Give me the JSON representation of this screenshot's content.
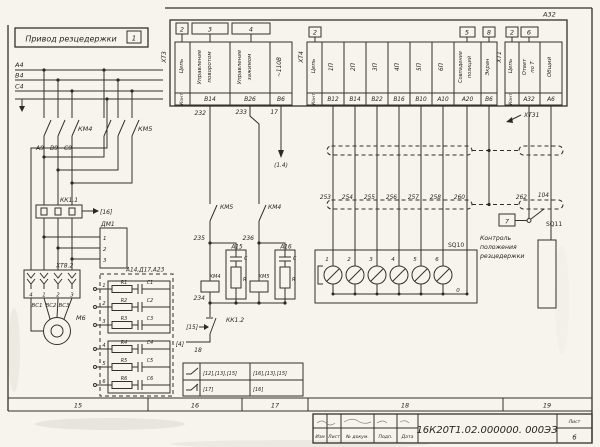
{
  "sheet": {
    "title": "Привод резцедержки",
    "title_zone": "1",
    "doc_number": "16К20Т1.02.000000. 000ЭЗ",
    "sheet_word": "Лист",
    "sheet_number": "6",
    "titleblock_labels": [
      "Изм",
      "Лист",
      "№ докум.",
      "Подп.",
      "Дата"
    ],
    "zones": [
      "15",
      "16",
      "17",
      "18",
      "19"
    ],
    "paper_color": "#f6f4ed",
    "ink_color": "#2e2b24"
  },
  "device": {
    "label": "А32"
  },
  "connectors": {
    "xt3": {
      "name": "ХТ3",
      "circuit_header": "Цепь",
      "contact_header": "Конт",
      "refs": [
        "2",
        "3",
        "4"
      ],
      "cols": [
        {
          "line1": "Управление",
          "line2": "поворотом",
          "pin": "В14",
          "wire": "232"
        },
        {
          "line1": "Управление",
          "line2": "зажимом",
          "pin": "В26",
          "wire": "233"
        },
        {
          "line1": "~110В",
          "line2": "",
          "pin": "В6",
          "wire": "17"
        }
      ]
    },
    "xt4": {
      "name": "ХТ4",
      "circuit_header": "Цепь",
      "contact_header": "Конт",
      "refs": [
        "2",
        "5",
        "8"
      ],
      "cols": [
        {
          "line1": "1П",
          "pin": "В12",
          "wire": "253"
        },
        {
          "line1": "2П",
          "pin": "В14",
          "wire": "254"
        },
        {
          "line1": "3П",
          "pin": "В22",
          "wire": "255"
        },
        {
          "line1": "4П",
          "pin": "В16",
          "wire": "256"
        },
        {
          "line1": "5П",
          "pin": "В10",
          "wire": "257"
        },
        {
          "line1": "6П",
          "pin": "А10",
          "wire": "258"
        },
        {
          "line1": "Совпадение",
          "line2": "позиций",
          "pin": "А20",
          "wire": "260"
        },
        {
          "line1": "Экран",
          "pin": "В6",
          "wire": ""
        }
      ]
    },
    "xt1": {
      "name": "ХТ1",
      "circuit_header": "Цепь",
      "contact_header": "Конт",
      "refs": [
        "2",
        "6"
      ],
      "cols": [
        {
          "line1": "Ответ",
          "line2": "по Т",
          "pin": "А32",
          "wire": "262"
        },
        {
          "line1": "Общий",
          "line2": "",
          "pin": "А6",
          "wire": "104"
        }
      ]
    },
    "xt31_label": "ХТ31",
    "xt82": {
      "name": "ХТ8.2",
      "terminals": [
        "4",
        "1",
        "2",
        "3"
      ]
    }
  },
  "power": {
    "phase_labels": [
      "А4",
      "В4",
      "С4"
    ],
    "km4_contact": "КМ4",
    "km5_contact": "КМ5",
    "wire_labels": [
      "А9",
      "В9",
      "С9"
    ],
    "kk1_1": "КК1.1",
    "kk1_1_ref": "[16]",
    "motor": "М6",
    "motor_wires": [
      "ВС1",
      "ВС2",
      "ВС3"
    ],
    "dm1": {
      "label": "ДМ1",
      "terminals": [
        "1",
        "2",
        "3"
      ]
    },
    "snubber_block": {
      "label": "А14,Д17,А23",
      "terminals": [
        "1",
        "2",
        "3",
        "4",
        "5",
        "6"
      ],
      "resistors": [
        "R1",
        "R2",
        "R3",
        "R4",
        "R5",
        "R6"
      ],
      "capacitors": [
        "С1",
        "С2",
        "С3",
        "С4",
        "С5",
        "С6"
      ]
    }
  },
  "control": {
    "w235": "235",
    "w236": "236",
    "w234": "234",
    "w18": "18",
    "ref14": "(1.4)",
    "ref15": "[15]",
    "ref4": "[4]",
    "km5_interlock": "КМ5",
    "km4_interlock": "КМ4",
    "km4_coil": "КМ4",
    "km5_coil": "КМ5",
    "a15": {
      "label": "А15",
      "c": "С",
      "r": "R"
    },
    "a16": {
      "label": "А16",
      "c": "С",
      "r": "R"
    },
    "kk1_2": "КК1.2",
    "usage_table": {
      "rows": [
        {
          "refs_a": "[12],[13],[15]",
          "refs_b": "[16],[13],[15]"
        },
        {
          "refs_a": "[17]",
          "refs_b": "[16]"
        }
      ]
    }
  },
  "position": {
    "sq10": {
      "label": "SQ10",
      "numbers": [
        "1",
        "2",
        "3",
        "4",
        "5",
        "6"
      ],
      "common": "0"
    },
    "sq11": {
      "label": "SQ11",
      "zone_ref": "7"
    },
    "note_lines": [
      "Контроль",
      "положения",
      "резцедержки"
    ]
  }
}
